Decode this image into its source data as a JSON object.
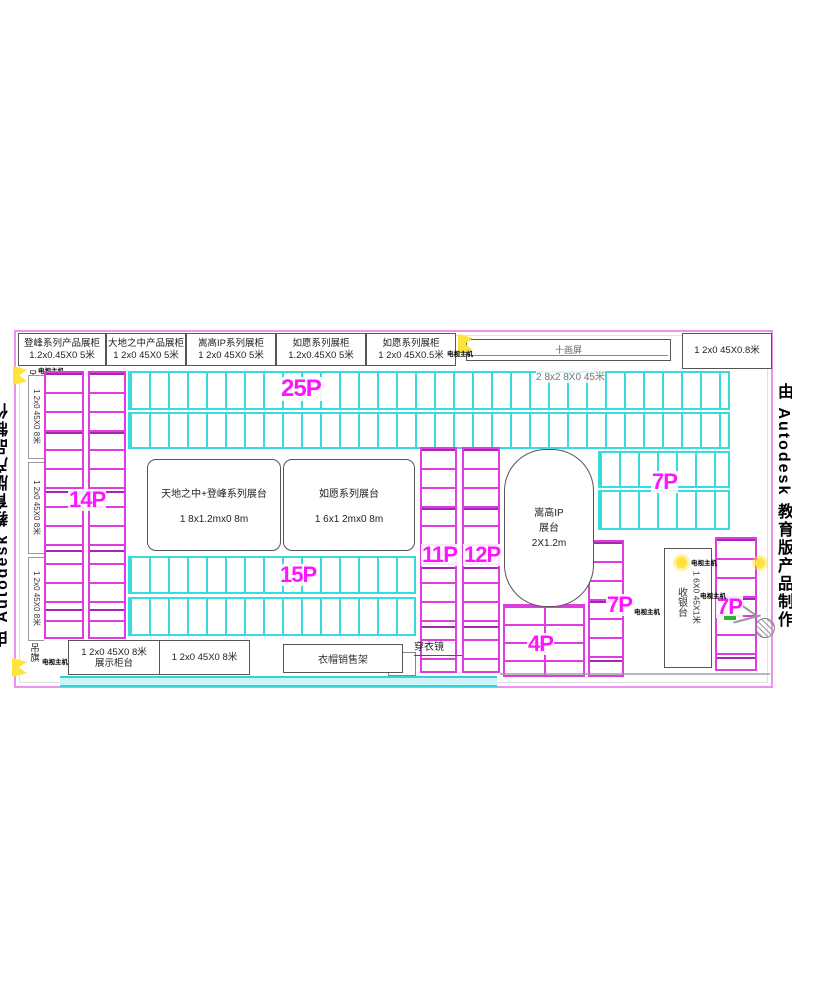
{
  "watermark": "由 Autodesk 教育版产品制作",
  "top_cabinets": [
    {
      "name": "登峰系列产品展柜",
      "size": "1.2x0.45X0 5米"
    },
    {
      "name": "大地之中产品展柜",
      "size": "1 2x0 45X0 5米"
    },
    {
      "name": "嵩高IP系列展柜",
      "size": "1 2x0 45X0 5米"
    },
    {
      "name": "如愿系列展柜",
      "size": "1.2x0.45X0 5米"
    },
    {
      "name": "如愿系列展柜",
      "size": "1 2x0 45X0.5米"
    }
  ],
  "top_wall": {
    "screen": "十画屏",
    "corner_cabinet": "1 2x0 45X0.8米"
  },
  "annotations": {
    "host_note": "电视主机",
    "hanging_banner": "吊旗"
  },
  "left_wall": {
    "shelf_dim": "1 2x0 45X0 8米"
  },
  "center_grid_dim": "2 8x2 8X0 45米",
  "zones": {
    "z25": "25P",
    "z14": "14P",
    "z15": "15P",
    "z11": "11P",
    "z12": "12P",
    "z7": "7P",
    "z4": "4P"
  },
  "platforms": [
    {
      "name": "天地之中+登峰系列展台",
      "size": "1 8x1.2mx0 8m"
    },
    {
      "name": "如愿系列展台",
      "size": "1 6x1 2mx0 8m"
    }
  ],
  "ip_stage": {
    "line1": "嵩高IP",
    "line2": "展台",
    "line3": "2X1.2m"
  },
  "cashier": {
    "name": "收银台",
    "size": "1 6X0 45X1米"
  },
  "bottom": {
    "display_dim": "1 2x0 45X0 8米",
    "display_name": "展示柜台",
    "display_dim2": "1 2x0 45X0 8米",
    "clothes_rack": "衣帽销售架",
    "mirror": "穿衣镜"
  }
}
